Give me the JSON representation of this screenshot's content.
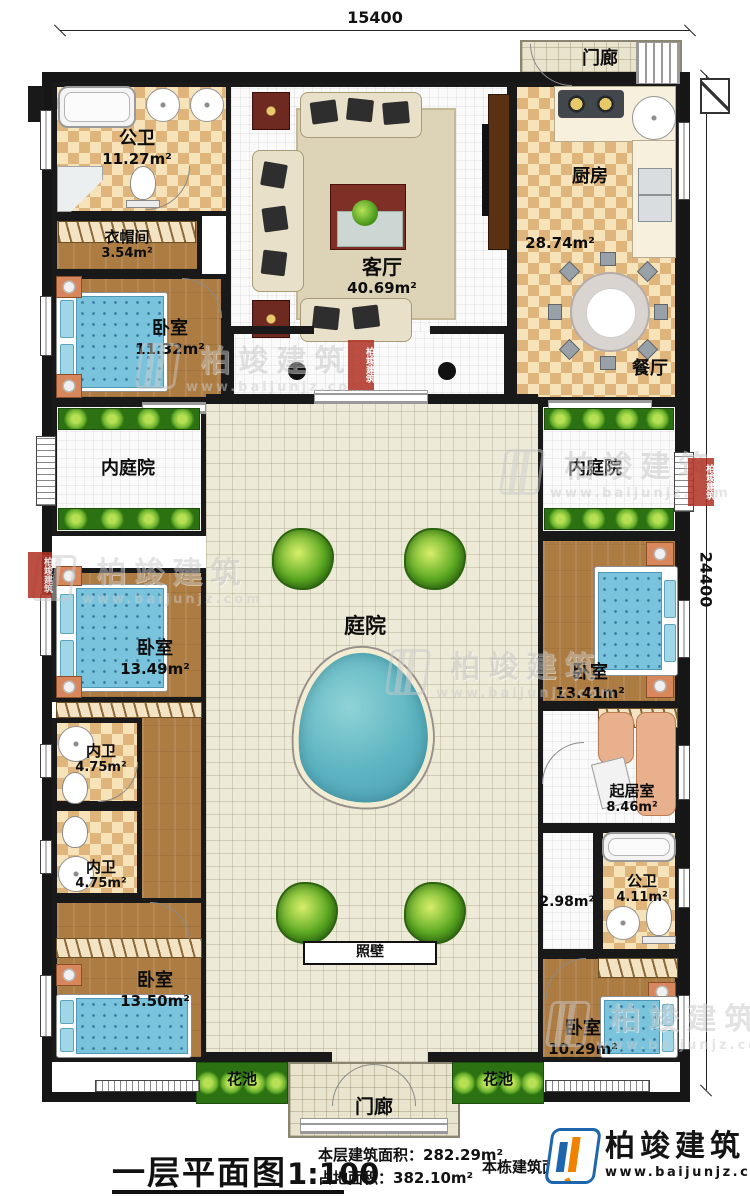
{
  "dimensions": {
    "width_mm": "15400",
    "height_mm": "24400"
  },
  "rooms": {
    "porch_top": {
      "label": "门廊"
    },
    "public_bath_top": {
      "label": "公卫",
      "area": "11.27m²"
    },
    "cloakroom": {
      "label": "衣帽间",
      "area": "3.54m²"
    },
    "bedroom_top_left": {
      "label": "卧室",
      "area": "11.32m²"
    },
    "living_room": {
      "label": "客厅",
      "area": "40.69m²"
    },
    "kitchen": {
      "label": "厨房",
      "area": "28.74m²"
    },
    "dining_room": {
      "label": "餐厅"
    },
    "inner_courtyard_left": {
      "label": "内庭院"
    },
    "inner_courtyard_right": {
      "label": "内庭院"
    },
    "courtyard": {
      "label": "庭院"
    },
    "bedroom_mid_left": {
      "label": "卧室",
      "area": "13.49m²"
    },
    "inner_bath_upper": {
      "label": "内卫",
      "area": "4.75m²"
    },
    "inner_bath_lower": {
      "label": "内卫",
      "area": "4.75m²"
    },
    "bedroom_bottom_left": {
      "label": "卧室",
      "area": "13.50m²"
    },
    "bedroom_mid_right": {
      "label": "卧室",
      "area": "13.41m²"
    },
    "sitting_room": {
      "label": "起居室",
      "area": "8.46m²"
    },
    "hall": {
      "area": "2.98m²"
    },
    "public_bath_right": {
      "label": "公卫",
      "area": "4.11m²"
    },
    "bedroom_bottom_right": {
      "label": "卧室",
      "area": "10.29m²"
    },
    "screen_wall": {
      "label": "照壁"
    },
    "flower_bed_left": {
      "label": "花池"
    },
    "flower_bed_right": {
      "label": "花池"
    },
    "porch_bottom": {
      "label": "门廊"
    }
  },
  "watermark": {
    "text": "柏竣建筑",
    "url": "www.baijunjz.com"
  },
  "footer": {
    "title": "一层平面图",
    "scale": "1:100",
    "floor_area_label": "本层建筑面积：",
    "floor_area_value": "282.29m²",
    "land_area_label": "占地面积：",
    "land_area_value": "382.10m²",
    "building_area_label": "本栋建筑面积：",
    "brand": "柏竣建筑",
    "brand_url": "www.baijunjz.com"
  }
}
